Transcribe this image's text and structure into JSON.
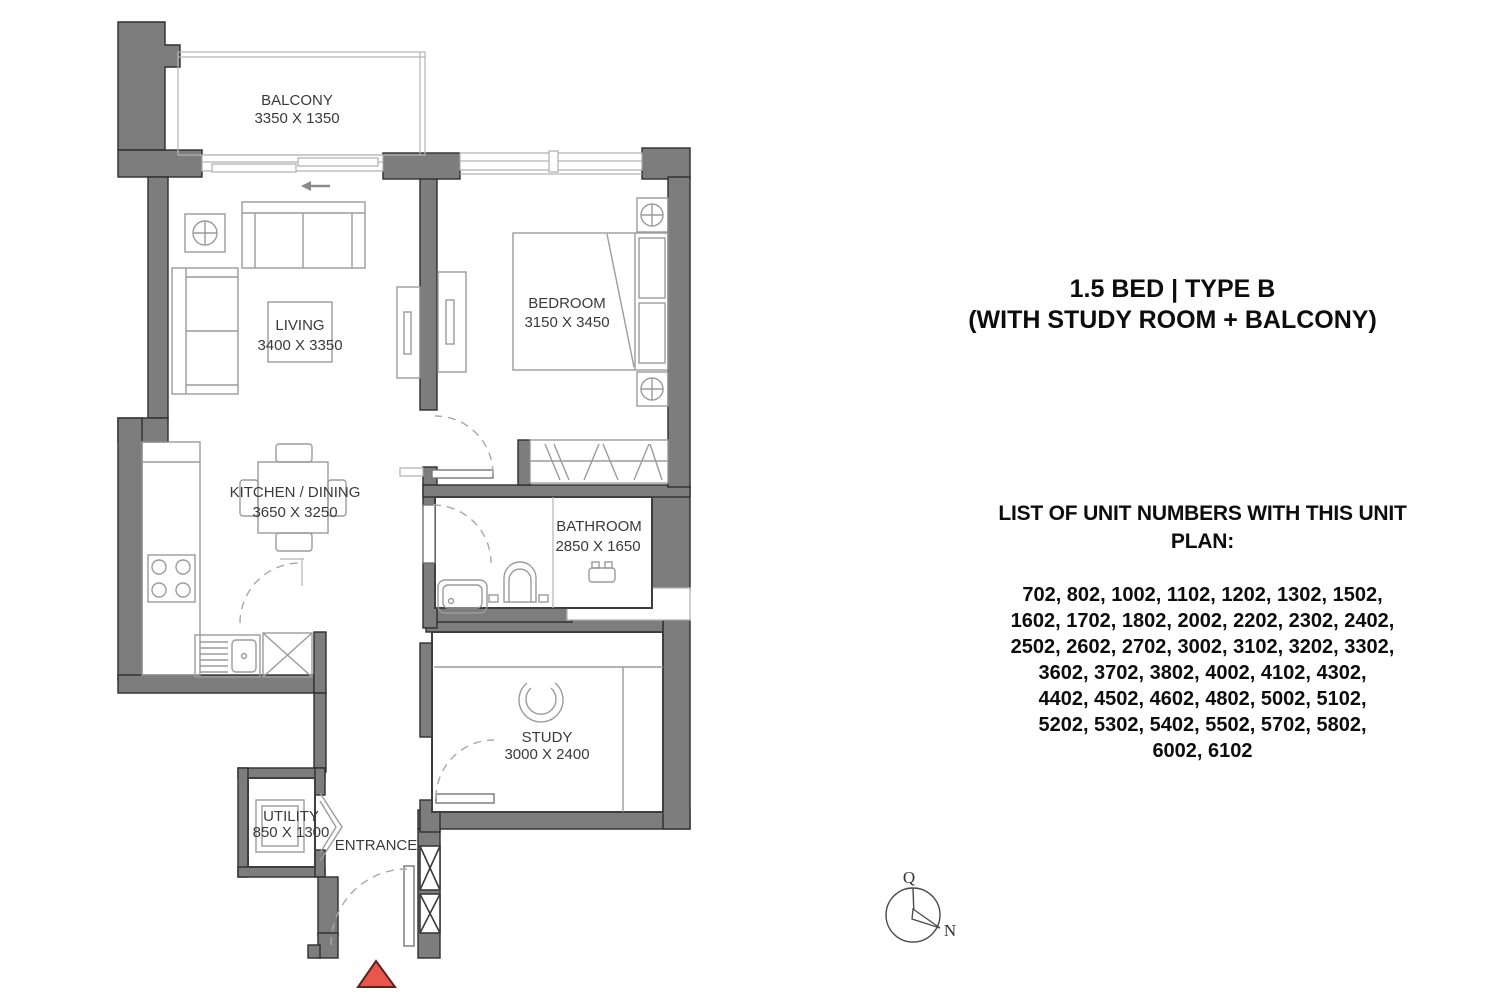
{
  "plan": {
    "rooms": [
      {
        "name": "BALCONY",
        "dims": "3350 X 1350"
      },
      {
        "name": "LIVING",
        "dims": "3400 X 3350"
      },
      {
        "name": "BEDROOM",
        "dims": "3150 X 3450"
      },
      {
        "name": "KITCHEN / DINING",
        "dims": "3650 X 3250"
      },
      {
        "name": "BATHROOM",
        "dims": "2850 X 1650"
      },
      {
        "name": "STUDY",
        "dims": "3000 X 2400"
      },
      {
        "name": "UTILITY",
        "dims": "850 X 1300"
      }
    ],
    "entrance_label": "ENTRANCE",
    "icons": {
      "entrance_marker": "red-triangle",
      "balcony_slider": "left-arrow"
    },
    "colors": {
      "wall": "#7d7d7d",
      "wall_outline": "#2e2e2e",
      "furniture_line": "#9b9b9b",
      "window_line": "#b3b3b3",
      "label_text": "#3a3a3a",
      "entrance_marker": "#e8564e"
    }
  },
  "compass": {
    "top_label": "Q",
    "north_label": "N"
  },
  "info": {
    "title_line1": "1.5 BED | TYPE B",
    "title_line2": "(WITH STUDY ROOM + BALCONY)",
    "list_heading_line1": "LIST OF UNIT NUMBERS WITH THIS UNIT",
    "list_heading_line2": "PLAN:",
    "unit_lines": [
      "702, 802, 1002, 1102, 1202, 1302, 1502,",
      "1602, 1702, 1802, 2002, 2202, 2302, 2402,",
      "2502, 2602, 2702, 3002, 3102, 3202, 3302,",
      "3602, 3702, 3802, 4002, 4102, 4302,",
      "4402, 4502, 4602, 4802, 5002, 5102,",
      "5202, 5302, 5402, 5502, 5702, 5802,",
      "6002, 6102"
    ]
  }
}
